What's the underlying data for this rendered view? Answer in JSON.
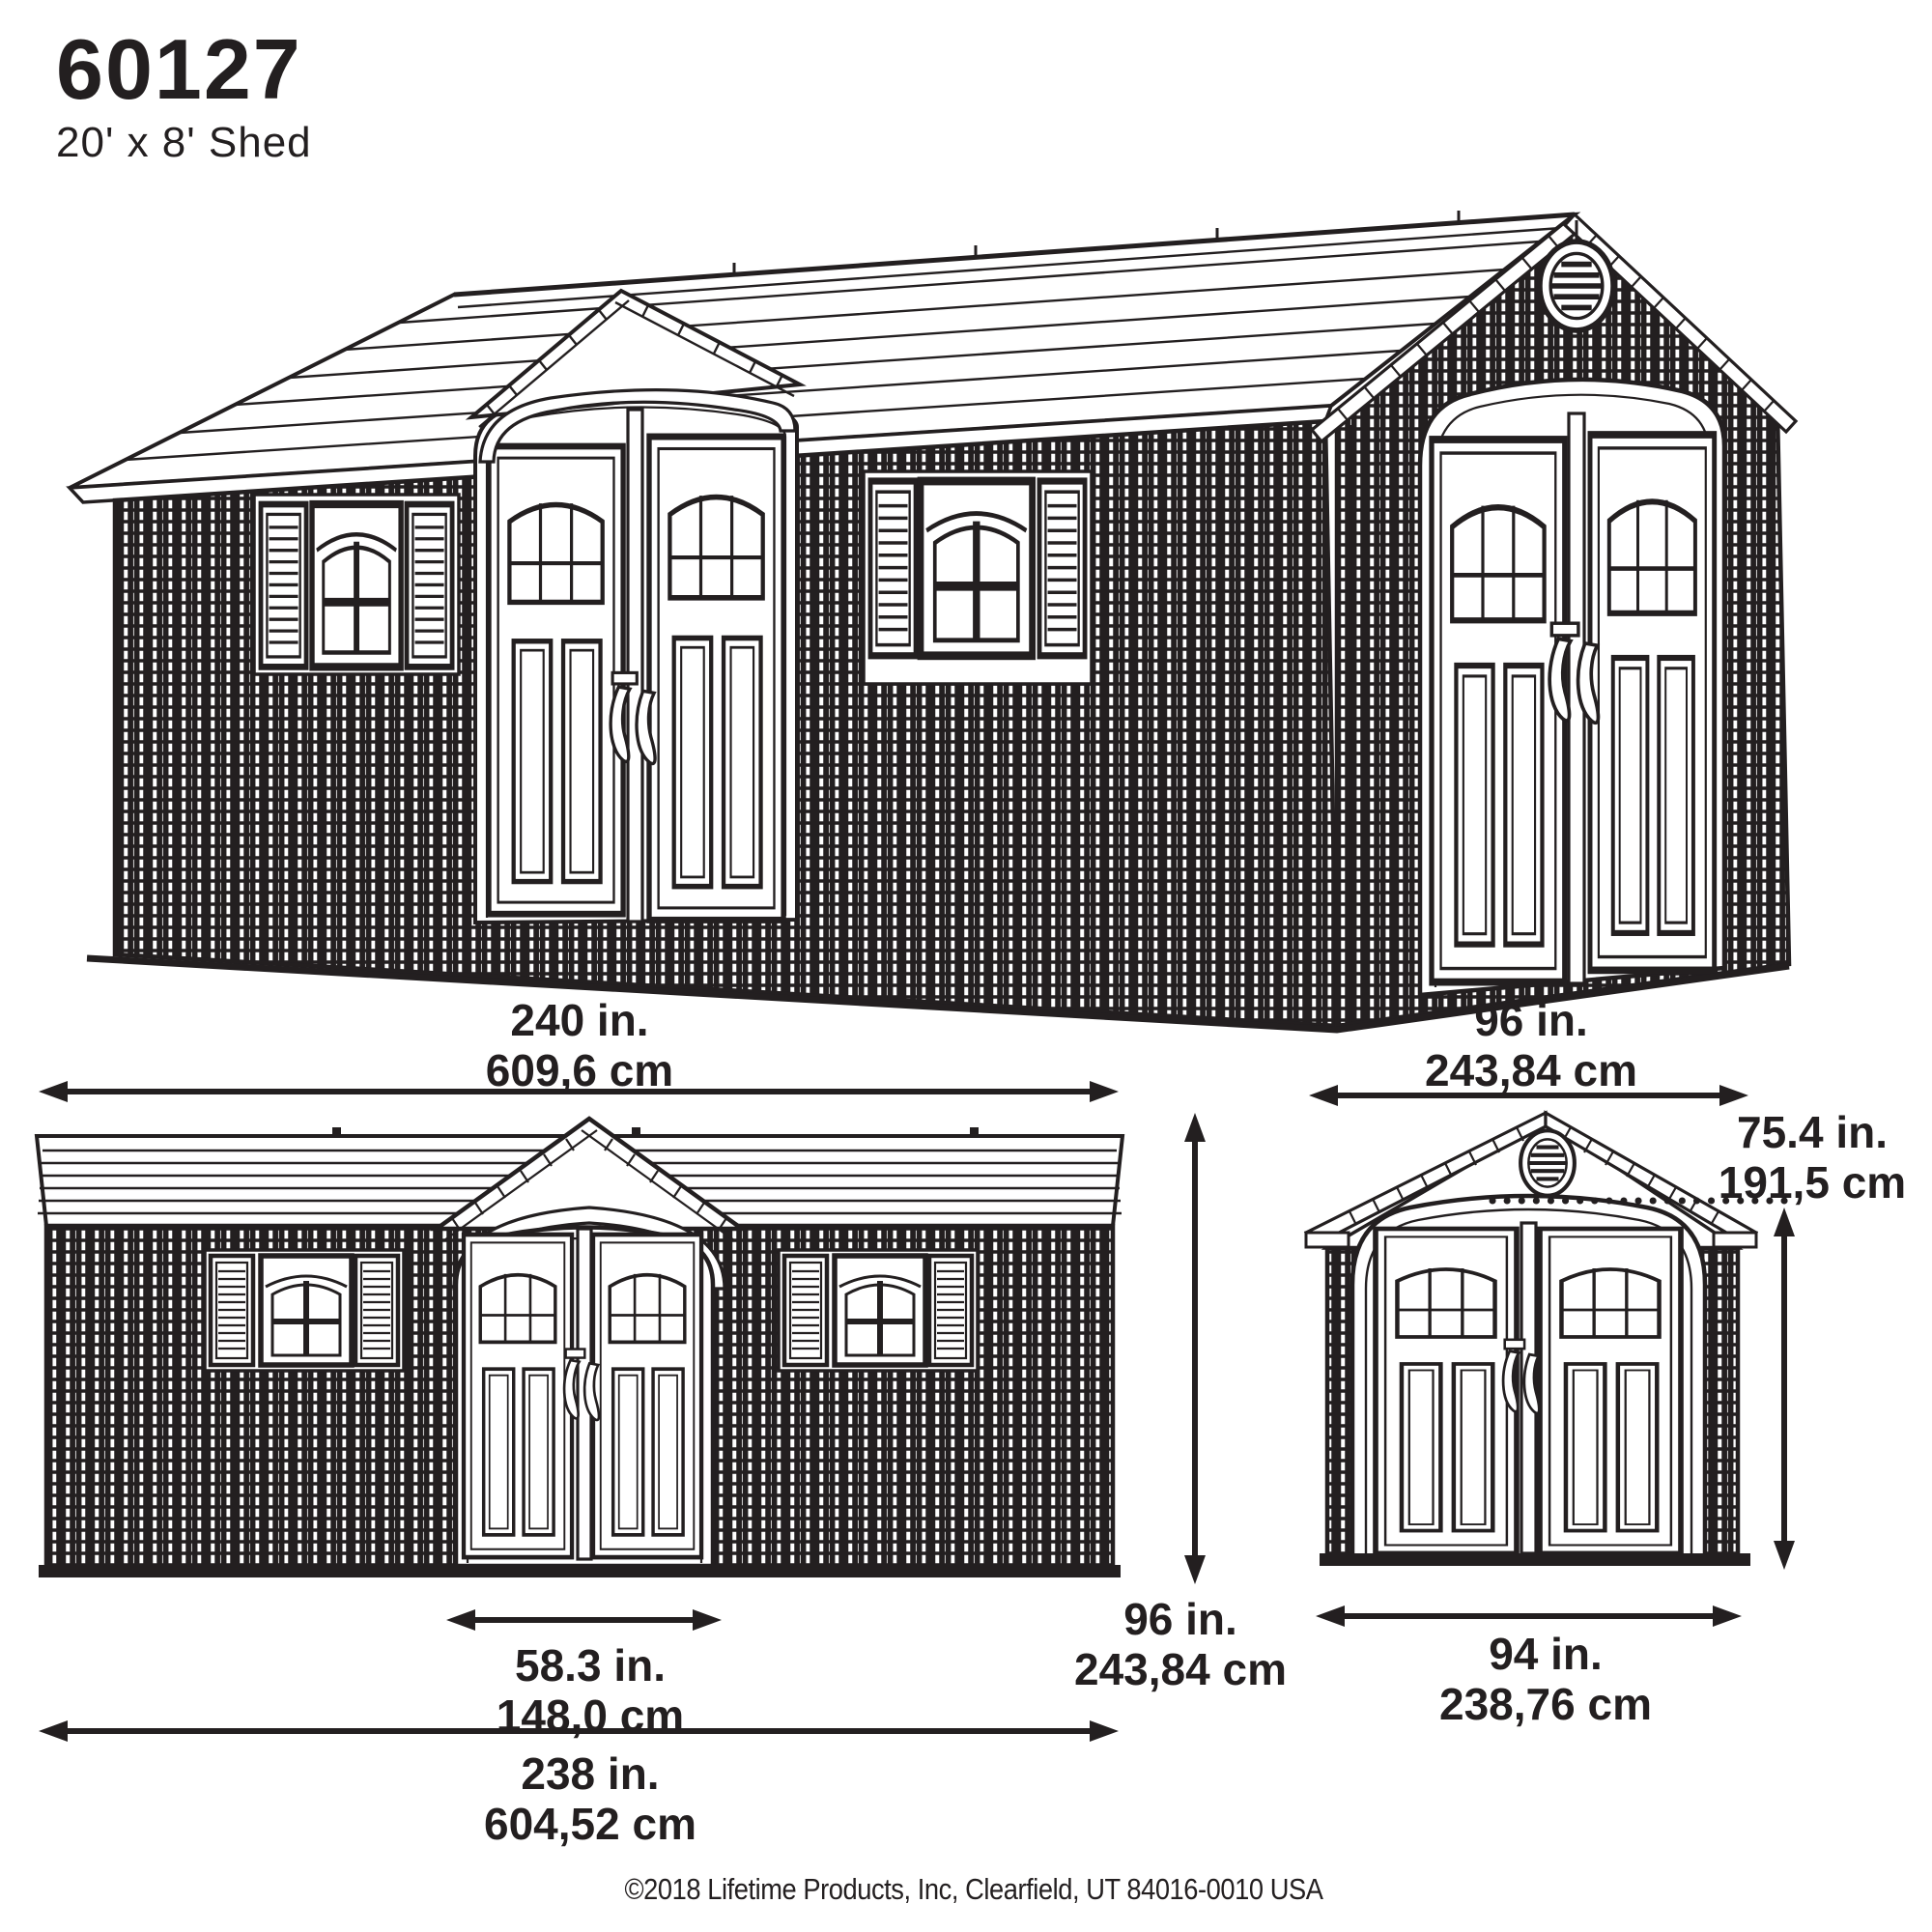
{
  "header": {
    "model": "60127",
    "subtitle": "20' x 8' Shed"
  },
  "dimensions": {
    "front_width_top": {
      "inches": "240 in.",
      "metric": "609,6 cm"
    },
    "side_width_top": {
      "inches": "96 in.",
      "metric": "243,84 cm"
    },
    "door_top_height": {
      "inches": "75.4 in.",
      "metric": "191,5 cm"
    },
    "wall_height": {
      "inches": "96 in.",
      "metric": "243,84 cm"
    },
    "door_opening_width": {
      "inches": "58.3 in.",
      "metric": "148,0 cm"
    },
    "base_length": {
      "inches": "238 in.",
      "metric": "604,52 cm"
    },
    "side_base_width": {
      "inches": "94 in.",
      "metric": "238,76 cm"
    }
  },
  "footer": {
    "copyright": "©2018 Lifetime Products, Inc, Clearfield, UT 84016-0010 USA"
  },
  "colors": {
    "ink": "#231f20",
    "paper": "#ffffff"
  }
}
